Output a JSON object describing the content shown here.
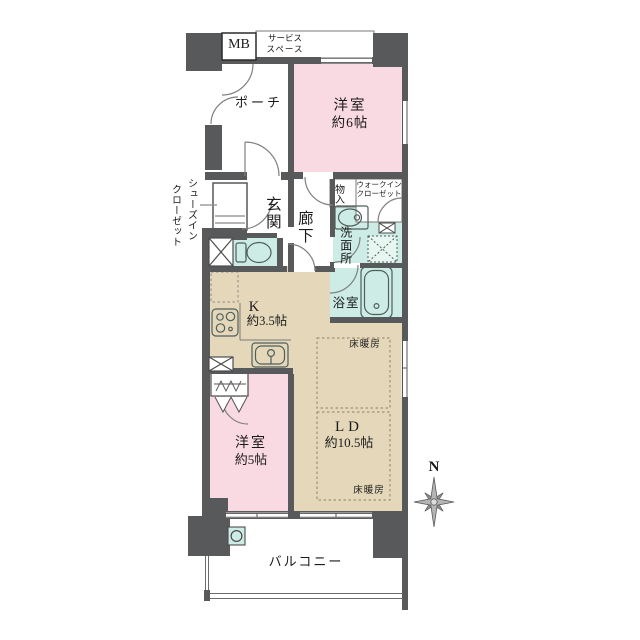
{
  "plan": {
    "title_type": "apartment-floor-plan",
    "colors": {
      "wall": "#58595b",
      "room_pink": "#f9d9e2",
      "room_beige": "#e5d8ba",
      "room_teal": "#cdece5",
      "line": "#6b6b6b"
    },
    "labels": {
      "meter_box": "MB",
      "service_space_line1": "サービス",
      "service_space_line2": "スペース",
      "porch": "ポーチ",
      "bedroom6_name": "洋室",
      "bedroom6_size": "約6帖",
      "shoes_closet_col1": "シューズイン",
      "shoes_closet_col2": "クローゼット",
      "entrance": "玄関",
      "hallway": "廊下",
      "storage": "物入",
      "walk_in_closet_line1": "ウォークイン",
      "walk_in_closet_line2": "クローゼット",
      "washroom": "洗面所",
      "bathroom": "浴室",
      "kitchen_name": "K",
      "kitchen_size": "約3.5帖",
      "floor_heating_top": "床暖房",
      "floor_heating_bottom": "床暖房",
      "living_dining_name": "LD",
      "living_dining_size": "約10.5帖",
      "bedroom5_name": "洋室",
      "bedroom5_size": "約5帖",
      "balcony": "バルコニー",
      "compass_north": "N"
    }
  }
}
